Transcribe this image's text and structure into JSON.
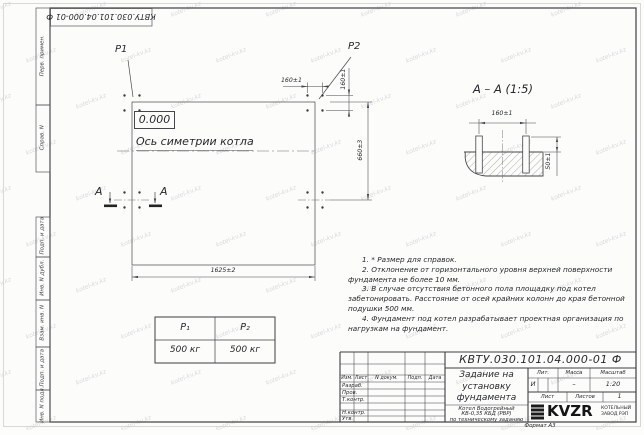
{
  "watermark": {
    "text": "kotel-kv.kz"
  },
  "stamp_top": {
    "designation": "КВТУ.030.101.04.000-01  Ф"
  },
  "side_labels": {
    "items": [
      "Перв. примен.",
      "Справ. N",
      "Подп. и дата",
      "Инв. N дубл.",
      "Взам. инв. N",
      "Подп. и дата",
      "Инв. N подл."
    ]
  },
  "plan": {
    "p1": "P1",
    "p2": "P2",
    "elevation": "0.000",
    "axis_label": "Ось симетрии котла",
    "dim_bolt_x": "160±1",
    "dim_bolt_y": "160±1",
    "dim_width": "660±3",
    "dim_length": "1625±2",
    "section_letter_left": "А",
    "section_letter_right": "А"
  },
  "section": {
    "title": "А – А (1:5)",
    "dim_bolts": "160±1",
    "dim_height": "50±1"
  },
  "load_table": {
    "h1": "P₁",
    "h2": "P₂",
    "v1": "500 кг",
    "v2": "500 кг"
  },
  "notes": {
    "items": [
      "1. * Размер для справок.",
      "2. Отклонение от горизонтального уровня верхней поверхности фундамента не более 10 мм.",
      "3. В случае отсутствия бетонного пола площадку под котел забетонировать. Расстояние от осей крайних колонн до края бетонной подушки 500 мм.",
      "4. Фундамент под котел разрабатывает проектная организация по нагрузкам на фундамент."
    ]
  },
  "title_block": {
    "designation": "КВТУ.030.101.04.000-01  Ф",
    "name_lines": [
      "Задание на",
      "установку",
      "фундамента"
    ],
    "desc_lines": [
      "Котел Водогрейный",
      "КВ-0,35 КБД (РВР)",
      "по техническому заданию"
    ],
    "cols": [
      "Изм.",
      "Лист",
      "N докум.",
      "Подп.",
      "Дата"
    ],
    "rows": [
      "Разраб.",
      "Пров.",
      "Т.контр.",
      "Н.контр.",
      "Утв."
    ],
    "lit": {
      "label": "Лит.",
      "value": "И"
    },
    "mass": {
      "label": "Масса",
      "value": "–"
    },
    "scale": {
      "label": "Масштаб",
      "value": "1:20"
    },
    "sheet": {
      "label": "Лист",
      "of_label": "Листов",
      "of_value": "1"
    },
    "logo": {
      "text": "KVZR",
      "caption1": "КОТЕЛЬНЫЙ",
      "caption2": "ЗАВОД РЭП"
    },
    "format": "Формат А3"
  }
}
